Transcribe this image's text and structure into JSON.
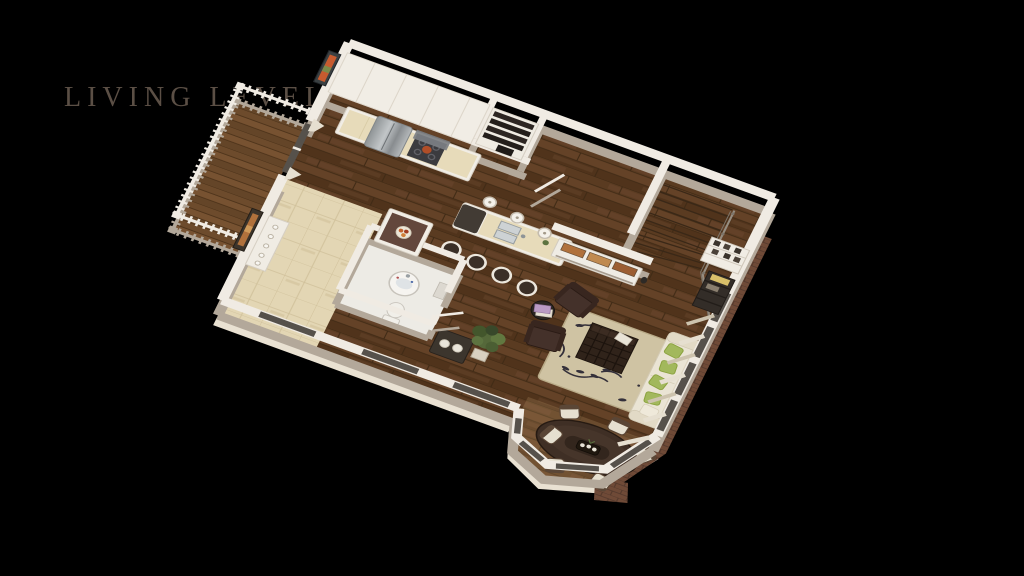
{
  "title": {
    "label": "LIVING LEVEL"
  },
  "theme": {
    "background": "#000000",
    "titleColor": "#5b4f45",
    "wallTop": "#f0ebe3",
    "wallFace": "#b3a89a",
    "floorWood": "#5a3b21",
    "floorSeam": "#3f2a15",
    "entryTile": "#e3d6b4",
    "bathFloor": "#edebe5",
    "deckWood": "#6d4b2c",
    "brick": "#6f4a37",
    "siding": "#e9e1d2",
    "rug": "#cfc3a3",
    "rugMotif": "#34303a",
    "sofaCream": "#eae4d4",
    "pillowGreen": "#a2b85c",
    "espresso": "#33261c",
    "leather": "#44312a",
    "stainless": "#a7abae",
    "counterTop": "#e7dbba",
    "counterWhite": "#f1ede5",
    "curtain": "#e6dfd0",
    "glass": "#56514b",
    "plantGreen": "#55683a",
    "accentOrange": "#c1622f"
  }
}
